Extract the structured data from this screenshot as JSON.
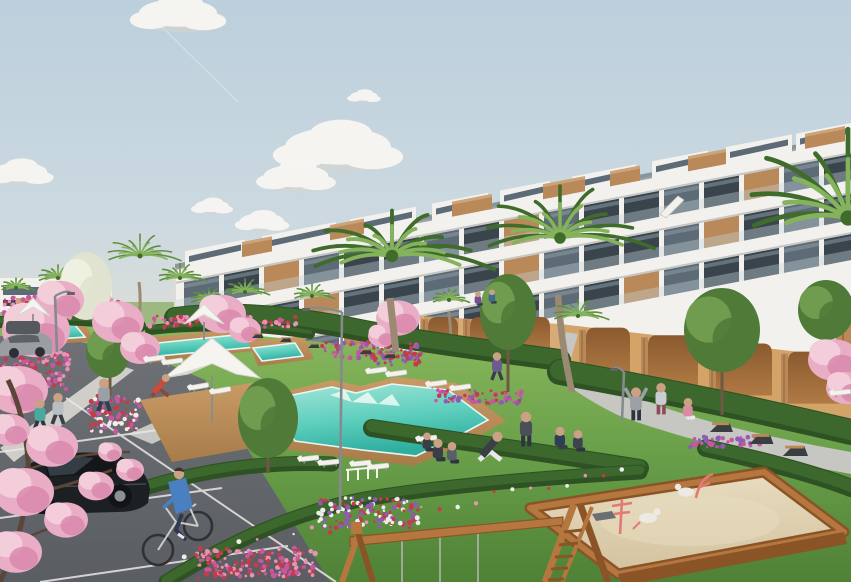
{
  "meta": {
    "width": 851,
    "height": 582,
    "alt_text": "Architectural rendering of a modern white tiered apartment complex with glass balconies and wood accents, turquoise swimming pools with wooden decks, palm trees, pink blossom trees, lawns, a parking area with a black car and cyclist, and a children's sandbox playground in the foreground."
  },
  "palette": {
    "sky_top": "#bccfdc",
    "sky_mid": "#ccd9e0",
    "sky_horizon": "#e7e1d5",
    "cloud": "#f8f6f3",
    "cloud_shadow": "#d9d3cc",
    "building_white": "#f2f1ee",
    "building_shade": "#dddcd8",
    "band_shadow": "#c6c6c3",
    "glass_dark": "#39444c",
    "glass_mid": "#5c6b75",
    "glass_light": "#8fa0aa",
    "balustrade": "#c6d4db",
    "wood": "#b9895a",
    "wood_dark": "#8f6236",
    "wood_light": "#cda478",
    "tan_wall": "#d3a368",
    "tan_dark": "#b07a45",
    "arch_dark": "#8a5a2e",
    "lawn": "#6aa04a",
    "lawn_light": "#8cb95f",
    "lawn_dark": "#4f8136",
    "lawn_far": "#9db981",
    "hedge": "#3c672d",
    "hedge_dark": "#2e5223",
    "tree_green": "#4f7a38",
    "tree_light": "#6f9c4e",
    "tree_white": "#dfe3cf",
    "palm_green": "#5d8f3f",
    "palm_dark": "#3f6b2b",
    "palm_light": "#85b35c",
    "trunk": "#9a8a74",
    "blossom": "#e9aec6",
    "blossom_dark": "#d886ab",
    "blossom_light": "#f3cdd9",
    "branch": "#5a4638",
    "flower_red": "#c43b4a",
    "flower_magenta": "#c857a0",
    "flower_purple": "#8e5bb5",
    "flower_pink": "#e794b4",
    "flower_white": "#ededea",
    "pool_light": "#a5e6d8",
    "pool_mid": "#5fcfbe",
    "pool_deep": "#2fae9f",
    "pool_edge": "#e8f7f3",
    "deck": "#c89a66",
    "deck_dark": "#a87c49",
    "path": "#c6c7c3",
    "path_edge": "#b2b3af",
    "sidewalk": "#cfcec8",
    "road": "#6e7276",
    "road_dark": "#5a5e62",
    "line_white": "#e8e8e6",
    "sand": "#e8dcc0",
    "sand_shadow": "#d3c29e",
    "play_wood": "#b5773f",
    "play_wood_dark": "#8a5426",
    "play_pink": "#e07a72",
    "car_black": "#1d2023",
    "car_glass": "#14161a",
    "car_gray": "#9a9ea2",
    "bench_dark": "#3a3d41",
    "bench_wood": "#b98a56",
    "lamp_gray": "#848a8d",
    "skin": "#caa184",
    "white": "#ffffff"
  },
  "scene": {
    "clouds": [
      {
        "x": 178,
        "y": 13,
        "s": 1.15
      },
      {
        "x": 364,
        "y": 96,
        "s": 0.4
      },
      {
        "x": 338,
        "y": 146,
        "s": 1.55
      },
      {
        "x": 296,
        "y": 176,
        "s": 0.95
      },
      {
        "x": 20,
        "y": 172,
        "s": 0.8
      },
      {
        "x": 212,
        "y": 206,
        "s": 0.5
      },
      {
        "x": 262,
        "y": 221,
        "s": 0.65
      }
    ],
    "penthouse_boxes": [
      {
        "x": 185,
        "w": 60
      },
      {
        "x": 262,
        "w": 74
      },
      {
        "x": 350,
        "w": 66
      },
      {
        "x": 432,
        "w": 56
      },
      {
        "x": 500,
        "w": 50
      },
      {
        "x": 572,
        "w": 64
      },
      {
        "x": 652,
        "w": 56
      },
      {
        "x": 726,
        "w": 66
      },
      {
        "x": 796,
        "w": 55
      }
    ],
    "roof_boxes": [
      {
        "x": 242,
        "w": 30
      },
      {
        "x": 330,
        "w": 34
      },
      {
        "x": 452,
        "w": 40
      },
      {
        "x": 543,
        "w": 42
      },
      {
        "x": 610,
        "w": 30
      },
      {
        "x": 688,
        "w": 38
      },
      {
        "x": 805,
        "w": 40
      }
    ],
    "window_rows": [
      {
        "off": 14,
        "h": 26,
        "woodEvery": 6,
        "woodPhase": 2
      },
      {
        "off": 54,
        "h": 26,
        "woodEvery": 5,
        "woodPhase": 3
      },
      {
        "off": 94,
        "h": 26,
        "woodEvery": 7,
        "woodPhase": 4
      }
    ],
    "arches_right": [
      {
        "x": 586,
        "w": 44
      },
      {
        "x": 648,
        "w": 50
      },
      {
        "x": 716,
        "w": 56
      },
      {
        "x": 788,
        "w": 52
      }
    ],
    "arches_left": [
      {
        "x": 428,
        "w": 30
      },
      {
        "x": 470,
        "w": 32
      },
      {
        "x": 516,
        "w": 34
      }
    ],
    "pools": [
      {
        "name": "main-pool",
        "deck": "250,400 332,380 360,386 396,377 456,383 506,421 468,442 414,466 358,459 283,449",
        "water": "268,400 332,387 356,393 392,384 448,390 488,420 462,434 416,456 362,450 295,441",
        "steps": "330,395 345,390 352,402 352,402 368,392 378,404 378,404 392,394 400,406"
      },
      {
        "name": "lap-pool-a",
        "deck": "136,339 252,327 270,349 150,363",
        "water": "148,344 245,334 256,347 158,356"
      },
      {
        "name": "lap-pool-b",
        "deck": "248,342 304,336 314,359 258,366",
        "water": "253,348 295,343 303,356 262,361"
      },
      {
        "name": "lap-pool-c",
        "deck": "0,324 82,318 94,341 6,348",
        "water": "6,330 75,325 85,337 14,342"
      }
    ],
    "umbrella_deck": "140,400 258,382 298,440 172,462",
    "hedges": [
      {
        "d": "M175,318 C240,310 300,318 360,330 C420,342 500,352 560,360",
        "w": 22
      },
      {
        "d": "M560,372 C650,388 750,408 851,432",
        "w": 26
      },
      {
        "d": "M372,428 C450,440 540,452 640,468",
        "w": 18
      },
      {
        "d": "M148,487 C205,470 265,461 332,464",
        "w": 15
      },
      {
        "d": "M166,582 C235,538 300,512 360,500 C430,487 540,478 640,472",
        "w": 15,
        "flowers": true
      },
      {
        "d": "M706,448 C770,462 820,476 851,488",
        "w": 18
      },
      {
        "d": "M0,322 C40,318 90,318 140,326",
        "w": 12
      },
      {
        "d": "M150,330 C200,324 260,326 310,334",
        "w": 10
      }
    ],
    "flowerbeds": [
      {
        "x": 148,
        "y": 316,
        "w": 150,
        "h": 12,
        "colors": [
          "flower_magenta",
          "flower_red",
          "flower_pink"
        ]
      },
      {
        "x": 322,
        "y": 342,
        "w": 100,
        "h": 16,
        "colors": [
          "flower_magenta",
          "flower_purple",
          "flower_red"
        ]
      },
      {
        "x": 436,
        "y": 390,
        "w": 90,
        "h": 14,
        "colors": [
          "flower_purple",
          "flower_red",
          "flower_magenta"
        ]
      },
      {
        "x": 88,
        "y": 396,
        "w": 52,
        "h": 36,
        "colors": [
          "flower_red",
          "flower_magenta",
          "flower_white"
        ]
      },
      {
        "x": 318,
        "y": 498,
        "w": 100,
        "h": 30,
        "colors": [
          "flower_purple",
          "flower_red",
          "flower_white"
        ]
      },
      {
        "x": 196,
        "y": 548,
        "w": 120,
        "h": 30,
        "colors": [
          "flower_red",
          "flower_magenta",
          "flower_pink"
        ]
      },
      {
        "x": 0,
        "y": 296,
        "w": 120,
        "h": 22,
        "colors": [
          "flower_pink",
          "flower_magenta",
          "flower_red"
        ]
      },
      {
        "x": 690,
        "y": 436,
        "w": 70,
        "h": 12,
        "colors": [
          "flower_purple",
          "flower_magenta"
        ]
      },
      {
        "x": 0,
        "y": 350,
        "w": 70,
        "h": 40,
        "colors": [
          "flower_pink",
          "flower_magenta",
          "flower_red"
        ]
      },
      {
        "x": 372,
        "y": 354,
        "w": 48,
        "h": 12,
        "colors": [
          "flower_purple",
          "flower_red"
        ]
      }
    ],
    "trees": [
      {
        "x": 268,
        "y": 418,
        "rx": 30,
        "ry": 40,
        "tx": 268,
        "tb": 473
      },
      {
        "x": 508,
        "y": 312,
        "rx": 28,
        "ry": 38,
        "tx": 508,
        "tb": 392
      },
      {
        "x": 722,
        "y": 330,
        "rx": 38,
        "ry": 42,
        "tx": 722,
        "tb": 415
      },
      {
        "x": 826,
        "y": 310,
        "rx": 28,
        "ry": 30
      },
      {
        "x": 108,
        "y": 352,
        "rx": 22,
        "ry": 26,
        "tx": 110,
        "tb": 396
      },
      {
        "x": 86,
        "y": 286,
        "rx": 26,
        "ry": 34,
        "white": true
      }
    ],
    "palms_back": [
      {
        "x": 140,
        "y": 256,
        "r": 40,
        "t": [
          [
            139,
            282
          ],
          [
            137,
            330
          ]
        ]
      },
      {
        "x": 58,
        "y": 278,
        "r": 24,
        "t": [
          [
            58,
            292
          ],
          [
            57,
            318
          ]
        ]
      },
      {
        "x": 16,
        "y": 288,
        "r": 18
      },
      {
        "x": 180,
        "y": 278,
        "r": 26
      },
      {
        "x": 245,
        "y": 292,
        "r": 24
      },
      {
        "x": 312,
        "y": 296,
        "r": 22
      },
      {
        "x": 209,
        "y": 300,
        "r": 22,
        "t": [
          [
            209,
            312
          ],
          [
            210,
            362
          ]
        ]
      },
      {
        "x": 449,
        "y": 300,
        "r": 20,
        "t": [
          [
            449,
            312
          ],
          [
            450,
            360
          ]
        ]
      },
      {
        "x": 820,
        "y": 312,
        "r": 26
      }
    ],
    "palms_mid": [
      {
        "x": 392,
        "y": 256,
        "r": 100,
        "ry": 0.5,
        "t": [
          [
            390,
            298
          ],
          [
            396,
            352
          ]
        ]
      },
      {
        "x": 560,
        "y": 238,
        "r": 92,
        "ry": 0.62,
        "t": [
          [
            558,
            295
          ],
          [
            572,
            392
          ]
        ]
      },
      {
        "x": 578,
        "y": 316,
        "r": 30,
        "ry": 0.6
      }
    ],
    "palms_front": [
      {
        "x": 848,
        "y": 218,
        "r": 122,
        "ry": 0.8
      }
    ],
    "blossoms": [
      {
        "x": 36,
        "y": 330,
        "r": 34
      },
      {
        "x": 18,
        "y": 390,
        "r": 30
      },
      {
        "x": 60,
        "y": 300,
        "r": 24
      },
      {
        "x": 118,
        "y": 322,
        "r": 26
      },
      {
        "x": 140,
        "y": 348,
        "r": 20
      },
      {
        "x": 222,
        "y": 314,
        "r": 24
      },
      {
        "x": 245,
        "y": 330,
        "r": 16
      },
      {
        "x": 398,
        "y": 318,
        "r": 22
      },
      {
        "x": 382,
        "y": 336,
        "r": 14
      },
      {
        "x": 834,
        "y": 360,
        "r": 26
      },
      {
        "x": 846,
        "y": 388,
        "r": 20
      }
    ],
    "blossoms_front": [
      {
        "x": 52,
        "y": 446,
        "r": 26
      },
      {
        "x": 24,
        "y": 492,
        "r": 30
      },
      {
        "x": 66,
        "y": 520,
        "r": 22
      },
      {
        "x": 16,
        "y": 552,
        "r": 26
      },
      {
        "x": 96,
        "y": 486,
        "r": 18
      },
      {
        "x": 130,
        "y": 470,
        "r": 14
      },
      {
        "x": 110,
        "y": 452,
        "r": 12
      },
      {
        "x": 10,
        "y": 430,
        "r": 20
      }
    ],
    "people": [
      {
        "x": 40,
        "y": 430,
        "s": 1.9,
        "shirt": "#4aa89f",
        "pants": "#2e3440",
        "pose": "walk",
        "role": "jogger"
      },
      {
        "x": 58,
        "y": 424,
        "s": 1.9,
        "shirt": "#b9bec4",
        "pants": "#3a3f47",
        "pose": "walk",
        "role": "jogger"
      },
      {
        "x": 104,
        "y": 411,
        "s": 2.0,
        "shirt": "#9aa0a6",
        "pants": "#2f3d55",
        "pose": "walk",
        "role": "walker-with-bag"
      },
      {
        "x": 160,
        "y": 396,
        "s": 1.7,
        "shirt": "#c84b3c",
        "pants": "#8a4a3a",
        "pose": "bend",
        "role": "gardener"
      },
      {
        "x": 497,
        "y": 380,
        "s": 1.7,
        "shirt": "#6b5b8e",
        "pants": "#3a3f47",
        "pose": "walk",
        "role": "walker"
      },
      {
        "x": 490,
        "y": 460,
        "s": 2.2,
        "shirt": "#3a3f47",
        "pants": "#e8e8ea",
        "pose": "lunge",
        "role": "yoga"
      },
      {
        "x": 526,
        "y": 446,
        "s": 2.1,
        "shirt": "#4a4f57",
        "pants": "#2e3440",
        "pose": "stand",
        "role": "yoga"
      },
      {
        "x": 560,
        "y": 450,
        "s": 1.9,
        "shirt": "#2f3d55",
        "pants": "#3a3f47",
        "pose": "kneel",
        "role": "sitting"
      },
      {
        "x": 578,
        "y": 452,
        "s": 1.8,
        "shirt": "#3d4450",
        "pants": "#2e3440",
        "pose": "kneel",
        "role": "sitting"
      },
      {
        "x": 438,
        "y": 462,
        "s": 1.9,
        "shirt": "#3a3f47",
        "pants": "#2e3440",
        "pose": "sit",
        "role": "sitting"
      },
      {
        "x": 452,
        "y": 464,
        "s": 1.8,
        "shirt": "#55606b",
        "pants": "#2e3440",
        "pose": "sit",
        "role": "sitting"
      },
      {
        "x": 636,
        "y": 420,
        "s": 2.0,
        "shirt": "#9aa0a6",
        "pants": "#2e3440",
        "pose": "armsup",
        "role": "stretching"
      },
      {
        "x": 661,
        "y": 414,
        "s": 1.9,
        "shirt": "#c9cdd1",
        "pants": "#8a4a5a",
        "pose": "stand",
        "role": "standing"
      },
      {
        "x": 688,
        "y": 420,
        "s": 1.8,
        "shirt": "#d98ba4",
        "pants": "#e8e8ea",
        "pose": "sit",
        "role": "sitting"
      },
      {
        "x": 427,
        "y": 452,
        "s": 1.6,
        "shirt": "#3a3f47",
        "pants": "#2e3440",
        "pose": "sit",
        "role": "on-lounger"
      },
      {
        "x": 478,
        "y": 306,
        "s": 1.2,
        "shirt": "#7a4f8e",
        "pants": "#3a3f47",
        "pose": "sit",
        "role": "child"
      },
      {
        "x": 492,
        "y": 304,
        "s": 1.2,
        "shirt": "#3f6b8e",
        "pants": "#3a3f47",
        "pose": "sit",
        "role": "child"
      }
    ],
    "loungers": [
      {
        "x": 378,
        "y": 372,
        "a": -8
      },
      {
        "x": 398,
        "y": 375,
        "a": -8
      },
      {
        "x": 438,
        "y": 385,
        "a": -8
      },
      {
        "x": 462,
        "y": 389,
        "a": -8
      },
      {
        "x": 200,
        "y": 388,
        "a": -10
      },
      {
        "x": 222,
        "y": 392,
        "a": -10
      },
      {
        "x": 156,
        "y": 360,
        "a": -8
      },
      {
        "x": 174,
        "y": 363,
        "a": -8
      },
      {
        "x": 310,
        "y": 460,
        "a": -6
      },
      {
        "x": 330,
        "y": 464,
        "a": -6
      },
      {
        "x": 362,
        "y": 465,
        "a": -6
      },
      {
        "x": 380,
        "y": 468,
        "a": -6
      },
      {
        "x": 428,
        "y": 440,
        "a": -6
      },
      {
        "x": 842,
        "y": 394,
        "a": -6
      }
    ],
    "benches": [
      {
        "x": 722,
        "y": 432,
        "s": 1.1
      },
      {
        "x": 762,
        "y": 444,
        "s": 1.15
      },
      {
        "x": 796,
        "y": 456,
        "s": 1.2
      },
      {
        "x": 258,
        "y": 338,
        "s": 0.55
      },
      {
        "x": 286,
        "y": 342,
        "s": 0.55
      },
      {
        "x": 314,
        "y": 348,
        "s": 0.55
      },
      {
        "x": 366,
        "y": 354,
        "s": 0.6
      },
      {
        "x": 390,
        "y": 358,
        "s": 0.6
      }
    ],
    "umbrellas": [
      {
        "x": 212,
        "y": 372,
        "w": 96,
        "h": 34,
        "pole": 46
      },
      {
        "x": 204,
        "y": 318,
        "w": 40,
        "h": 14,
        "pole": 18
      },
      {
        "x": 33,
        "y": 310,
        "w": 34,
        "h": 12,
        "pole": 14
      }
    ],
    "lamps": [
      {
        "x": 340,
        "y": 510,
        "h": 198,
        "dir": -1,
        "arm": 36
      },
      {
        "x": 57,
        "y": 352,
        "h": 56,
        "dir": 1,
        "arm": 16
      },
      {
        "x": 622,
        "y": 420,
        "h": 48,
        "dir": -1,
        "arm": 10
      }
    ]
  }
}
